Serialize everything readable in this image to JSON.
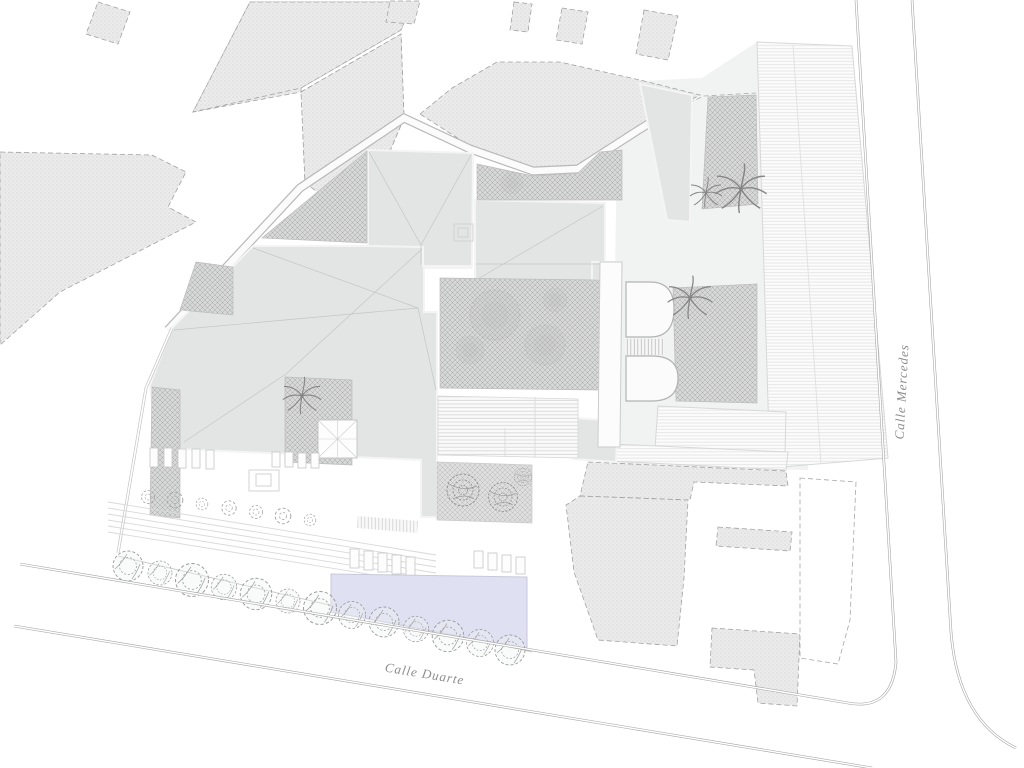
{
  "plan": {
    "streets": [
      {
        "id": "calle-duarte",
        "label": "Calle Duarte",
        "position": "bottom-diagonal"
      },
      {
        "id": "calle-mercedes",
        "label": "Calle Mercedes",
        "position": "right-vertical"
      }
    ],
    "palette": {
      "background": "#ffffff",
      "roof": "#e3e5e5",
      "courtyard_hatch": "#d6d7d7",
      "parcel_fill": "#ebebeb",
      "pool": "#dfe0f2",
      "street_line": "#9f9f9f",
      "label_text": "#8c8c8c"
    }
  }
}
